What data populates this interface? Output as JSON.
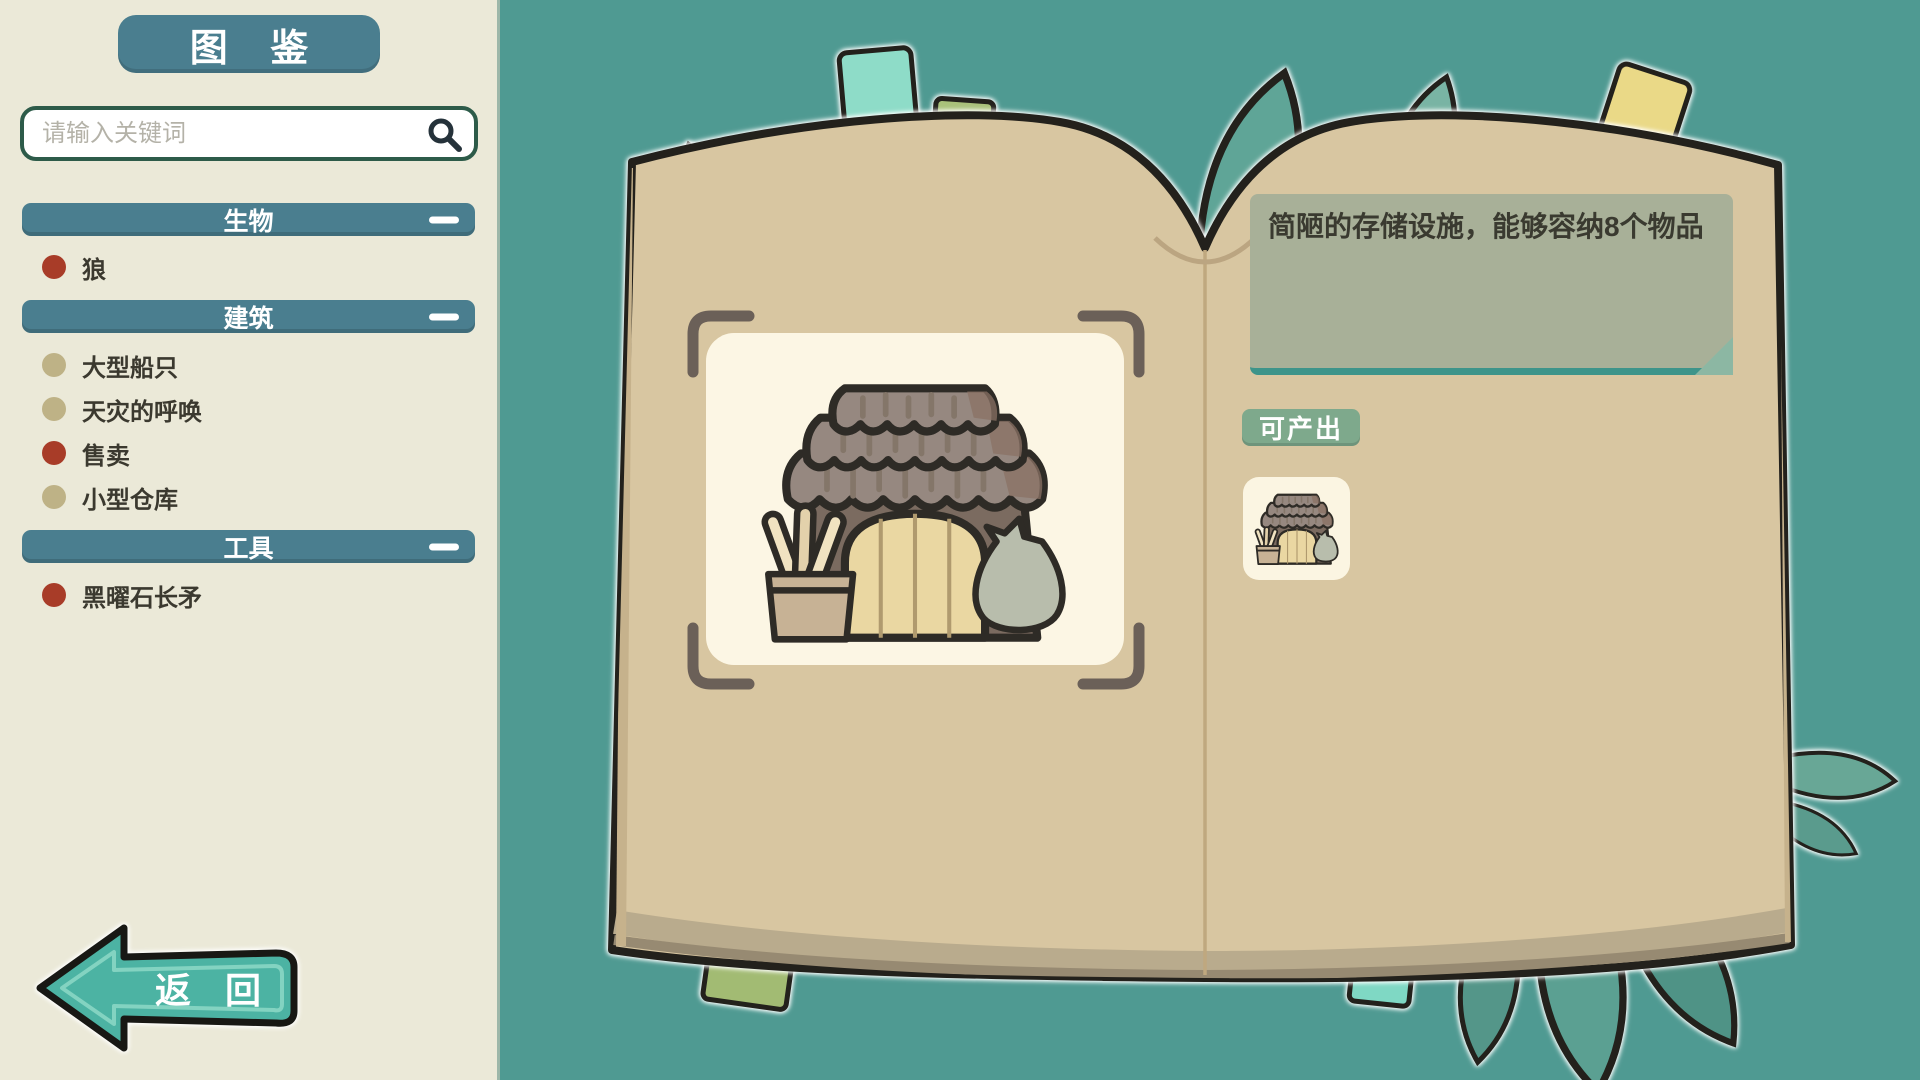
{
  "title": "图 鉴",
  "search": {
    "placeholder": "请输入关键词",
    "icon": "search-icon"
  },
  "sidebar": {
    "sections": [
      {
        "label": "生物",
        "state": "expanded",
        "collapse_icon": "minus-icon",
        "items": [
          {
            "label": "狼",
            "bullet_color": "#a83c28"
          }
        ]
      },
      {
        "label": "建筑",
        "state": "expanded",
        "collapse_icon": "minus-icon",
        "items": [
          {
            "label": "大型船只",
            "bullet_color": "#beb286"
          },
          {
            "label": "天灾的呼唤",
            "bullet_color": "#beb286"
          },
          {
            "label": "售卖",
            "bullet_color": "#a83c28"
          },
          {
            "label": "小型仓库",
            "bullet_color": "#beb286"
          }
        ]
      },
      {
        "label": "工具",
        "state": "expanded",
        "collapse_icon": "minus-icon",
        "items": [
          {
            "label": "黑曜石长矛",
            "bullet_color": "#a83c28"
          }
        ]
      }
    ]
  },
  "back_button": {
    "label": "返 回",
    "icon": "arrow-left-icon"
  },
  "detail_page": {
    "description": "简陋的存储设施，能够容纳8个物品",
    "produces_label": "可产出",
    "produces_items": [
      {
        "icon": "small-warehouse-icon"
      }
    ],
    "display_item_icon": "small-warehouse-icon"
  },
  "colors": {
    "background": "#4f9a92",
    "sidebar": "#ebe9d8",
    "header_bar": "#4a7e8f",
    "page": "#d8c6a1",
    "panel": "#fcf6e4",
    "description_box": "#a8b098",
    "produces_tag": "#7ea98c",
    "back_button": "#4cb3a3",
    "bullet_red": "#a83c28",
    "bullet_khaki": "#beb286"
  }
}
